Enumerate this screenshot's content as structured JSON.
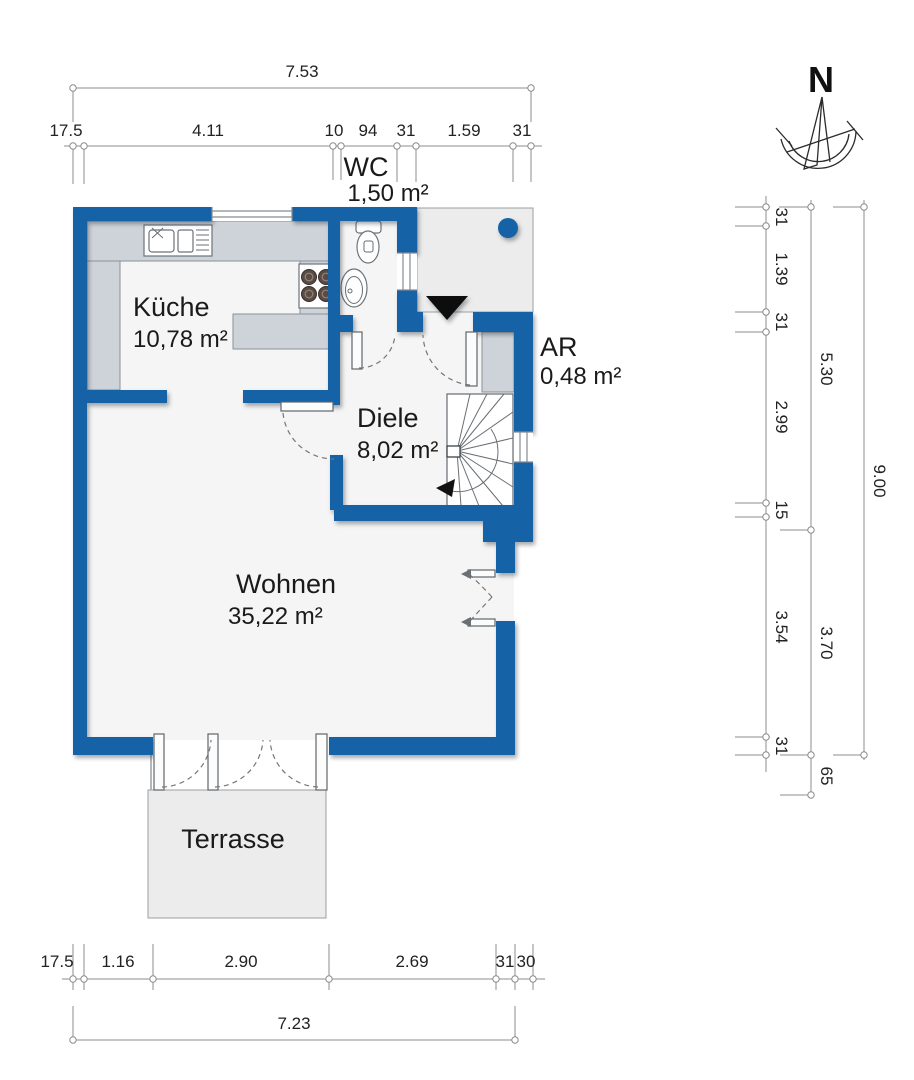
{
  "rooms": {
    "kueche": {
      "name": "Küche",
      "area": "10,78 m²"
    },
    "wc": {
      "name": "WC",
      "area": "1,50 m²"
    },
    "ar": {
      "name": "AR",
      "area": "0,48 m²"
    },
    "diele": {
      "name": "Diele",
      "area": "8,02 m²"
    },
    "wohnen": {
      "name": "Wohnen",
      "area": "35,22 m²"
    },
    "terrasse": {
      "name": "Terrasse"
    }
  },
  "compass": {
    "north_label": "N"
  },
  "dims": {
    "top_overall": "7.53",
    "top_chain": [
      "17.5",
      "4.11",
      "10",
      "94",
      "31",
      "1.59",
      "31"
    ],
    "bottom_chain": [
      "17.5",
      "1.16",
      "2.90",
      "2.69",
      "31",
      "30"
    ],
    "bottom_overall": "7.23",
    "right_chain": [
      "31",
      "1.39",
      "31",
      "2.99",
      "15",
      "3.54",
      "31"
    ],
    "right_mid": [
      "5.30",
      "3.70",
      "65"
    ],
    "right_overall": "9.00"
  },
  "colors": {
    "wall": "#1563a6",
    "floor": "#f4f5f4",
    "outdoor": "#ececec",
    "counter": "#cdd3d8",
    "burner": "#5a4c44",
    "dimline": "#8c8c8c",
    "label": "#1a1a1a"
  }
}
